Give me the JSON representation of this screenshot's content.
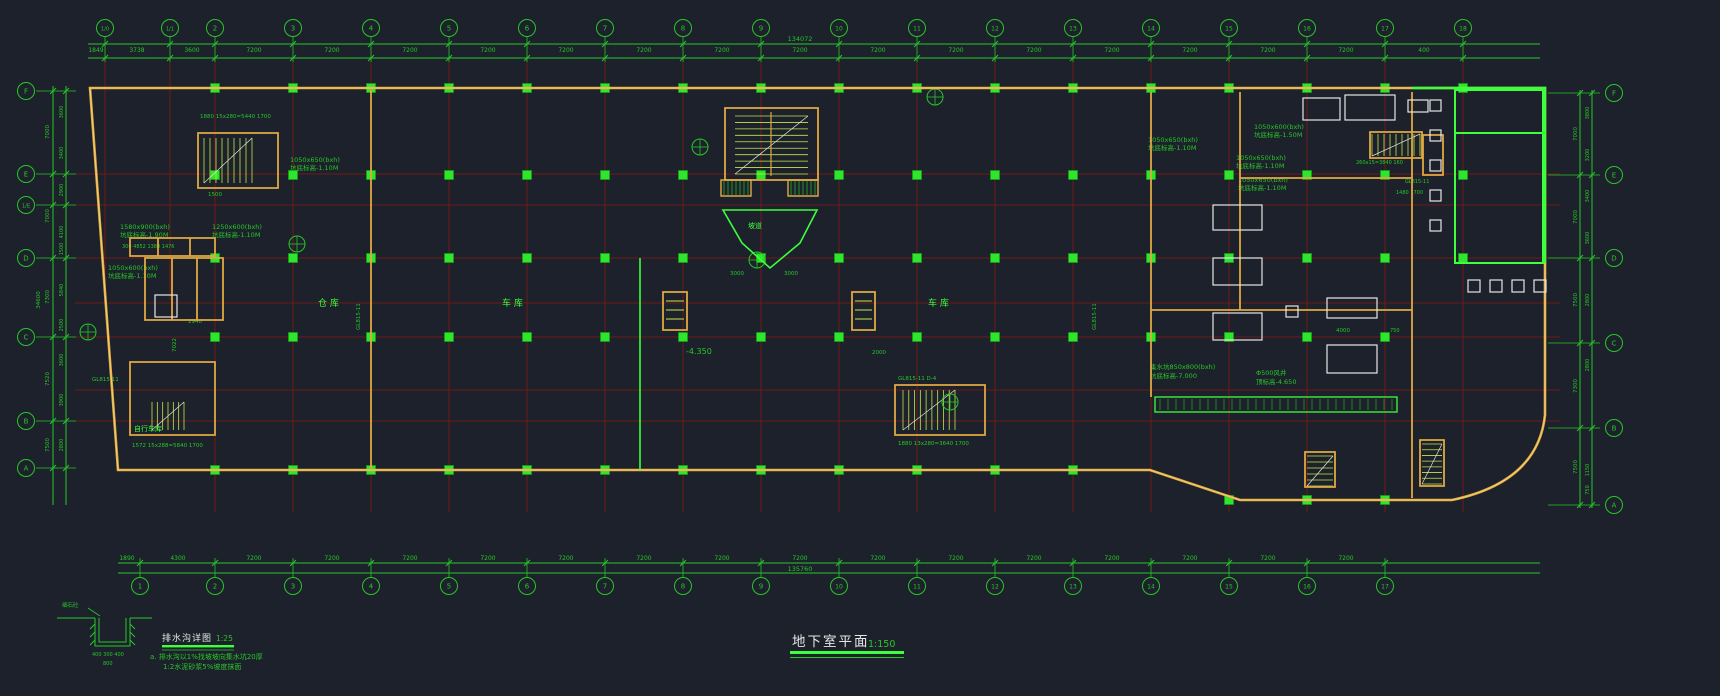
{
  "window": {
    "width": 1720,
    "height": 696
  },
  "colors": {
    "background": "#1c212b",
    "grid_red": "#6e1a1a",
    "dim_green": "#28c628",
    "bright_green": "#3dff3d",
    "column_green": "#2ee62e",
    "wall_yellow": "#e0a943",
    "wall_light": "#f6d879",
    "white": "#e6e6e6"
  },
  "title_block": {
    "title": "地下室平面",
    "scale": "1:150"
  },
  "detail_block": {
    "title": "排水沟详图",
    "scale": "1:25",
    "note1": "a. 排水沟以1%找坡坡向集水坑20厚",
    "note2": "1:2水泥砂浆5%坡度抹面",
    "dim1": "400  300  400",
    "dim2": "800",
    "label": "细石砼"
  },
  "grid": {
    "top_axes": [
      {
        "label": "1/0",
        "x": 105
      },
      {
        "label": "1/1",
        "x": 170
      },
      {
        "label": "2",
        "x": 215
      },
      {
        "label": "3",
        "x": 293
      },
      {
        "label": "4",
        "x": 371
      },
      {
        "label": "5",
        "x": 449
      },
      {
        "label": "6",
        "x": 527
      },
      {
        "label": "7",
        "x": 605
      },
      {
        "label": "8",
        "x": 683
      },
      {
        "label": "9",
        "x": 761
      },
      {
        "label": "10",
        "x": 839
      },
      {
        "label": "11",
        "x": 917
      },
      {
        "label": "12",
        "x": 995
      },
      {
        "label": "13",
        "x": 1073
      },
      {
        "label": "14",
        "x": 1151
      },
      {
        "label": "15",
        "x": 1229
      },
      {
        "label": "16",
        "x": 1307
      },
      {
        "label": "17",
        "x": 1385
      },
      {
        "label": "18",
        "x": 1463
      }
    ],
    "bottom_axes": [
      {
        "label": "1",
        "x": 140
      },
      {
        "label": "2",
        "x": 215
      },
      {
        "label": "3",
        "x": 293
      },
      {
        "label": "4",
        "x": 371
      },
      {
        "label": "5",
        "x": 449
      },
      {
        "label": "6",
        "x": 527
      },
      {
        "label": "7",
        "x": 605
      },
      {
        "label": "8",
        "x": 683
      },
      {
        "label": "9",
        "x": 761
      },
      {
        "label": "10",
        "x": 839
      },
      {
        "label": "11",
        "x": 917
      },
      {
        "label": "12",
        "x": 995
      },
      {
        "label": "13",
        "x": 1073
      },
      {
        "label": "14",
        "x": 1151
      },
      {
        "label": "15",
        "x": 1229
      },
      {
        "label": "16",
        "x": 1307
      },
      {
        "label": "17",
        "x": 1385
      }
    ],
    "left_axes": [
      {
        "label": "F",
        "y": 91
      },
      {
        "label": "E",
        "y": 174
      },
      {
        "label": "1/E",
        "y": 205
      },
      {
        "label": "D",
        "y": 258
      },
      {
        "label": "C",
        "y": 337
      },
      {
        "label": "B",
        "y": 421
      },
      {
        "label": "A",
        "y": 468
      }
    ],
    "right_axes": [
      {
        "label": "F",
        "y": 93
      },
      {
        "label": "E",
        "y": 175
      },
      {
        "label": "D",
        "y": 258
      },
      {
        "label": "C",
        "y": 343
      },
      {
        "label": "B",
        "y": 428
      },
      {
        "label": "A",
        "y": 505
      }
    ],
    "top_dims": [
      {
        "v": "1849",
        "x": 96
      },
      {
        "v": "3738",
        "x": 137
      },
      {
        "v": "3600",
        "x": 192
      },
      {
        "v": "7200",
        "x": 254
      },
      {
        "v": "7200",
        "x": 332
      },
      {
        "v": "7200",
        "x": 410
      },
      {
        "v": "7200",
        "x": 488
      },
      {
        "v": "7200",
        "x": 566
      },
      {
        "v": "7200",
        "x": 644
      },
      {
        "v": "7200",
        "x": 722
      },
      {
        "v": "7200",
        "x": 800
      },
      {
        "v": "7200",
        "x": 878
      },
      {
        "v": "7200",
        "x": 956
      },
      {
        "v": "7200",
        "x": 1034
      },
      {
        "v": "7200",
        "x": 1112
      },
      {
        "v": "7200",
        "x": 1190
      },
      {
        "v": "7200",
        "x": 1268
      },
      {
        "v": "7200",
        "x": 1346
      },
      {
        "v": "400",
        "x": 1424
      }
    ],
    "top_total": "134072",
    "bottom_dims": [
      {
        "v": "1890",
        "x": 127
      },
      {
        "v": "4300",
        "x": 178
      },
      {
        "v": "7200",
        "x": 254
      },
      {
        "v": "7200",
        "x": 332
      },
      {
        "v": "7200",
        "x": 410
      },
      {
        "v": "7200",
        "x": 488
      },
      {
        "v": "7200",
        "x": 566
      },
      {
        "v": "7200",
        "x": 644
      },
      {
        "v": "7200",
        "x": 722
      },
      {
        "v": "7200",
        "x": 800
      },
      {
        "v": "7200",
        "x": 878
      },
      {
        "v": "7200",
        "x": 956
      },
      {
        "v": "7200",
        "x": 1034
      },
      {
        "v": "7200",
        "x": 1112
      },
      {
        "v": "7200",
        "x": 1190
      },
      {
        "v": "7200",
        "x": 1268
      },
      {
        "v": "7200",
        "x": 1346
      }
    ],
    "bottom_total": "135760",
    "left_total": "34600",
    "left_dims_outer": [
      {
        "v": "7000",
        "y": 132
      },
      {
        "v": "7000",
        "y": 216
      },
      {
        "v": "7300",
        "y": 297
      },
      {
        "v": "7520",
        "y": 379
      },
      {
        "v": "7500",
        "y": 445
      }
    ],
    "left_dims_inner": [
      {
        "v": "3600",
        "y": 112
      },
      {
        "v": "3400",
        "y": 153
      },
      {
        "v": "2900",
        "y": 190
      },
      {
        "v": "4100",
        "y": 232
      },
      {
        "v": "1500",
        "y": 249
      },
      {
        "v": "5840",
        "y": 290
      },
      {
        "v": "2500",
        "y": 325
      },
      {
        "v": "3600",
        "y": 360
      },
      {
        "v": "3900",
        "y": 400
      },
      {
        "v": "2800",
        "y": 445
      }
    ],
    "right_dims_outer": [
      {
        "v": "7000",
        "y": 134
      },
      {
        "v": "7000",
        "y": 217
      },
      {
        "v": "7500",
        "y": 300
      },
      {
        "v": "7300",
        "y": 386
      },
      {
        "v": "7500",
        "y": 467
      }
    ],
    "right_dims_inner": [
      {
        "v": "3800",
        "y": 113
      },
      {
        "v": "3200",
        "y": 155
      },
      {
        "v": "3400",
        "y": 196
      },
      {
        "v": "3600",
        "y": 238
      },
      {
        "v": "2800",
        "y": 300
      },
      {
        "v": "2800",
        "y": 365
      },
      {
        "v": "1150",
        "y": 470
      },
      {
        "v": "750",
        "y": 490
      }
    ]
  },
  "rooms": [
    {
      "t": "仓  库",
      "x": 318,
      "y": 306,
      "s": 9
    },
    {
      "t": "车  库",
      "x": 502,
      "y": 306,
      "s": 9
    },
    {
      "t": "车  库",
      "x": 928,
      "y": 306,
      "s": 9
    },
    {
      "t": "坡道",
      "x": 748,
      "y": 228,
      "s": 7
    },
    {
      "t": "自行车库",
      "x": 134,
      "y": 431,
      "s": 7
    }
  ],
  "annotations": [
    {
      "t": "1580x900(bxh)",
      "x": 120,
      "y": 229
    },
    {
      "t": "坑底标高-1.90M",
      "x": 120,
      "y": 237
    },
    {
      "t": "1250x600(bxh)",
      "x": 212,
      "y": 229
    },
    {
      "t": "坑底标高-1.10M",
      "x": 212,
      "y": 237
    },
    {
      "t": "1050x600(bxh)",
      "x": 108,
      "y": 270
    },
    {
      "t": "坑底标高-1.10M",
      "x": 108,
      "y": 278
    },
    {
      "t": "1050x650(bxh)",
      "x": 290,
      "y": 162
    },
    {
      "t": "坑底标高-1.10M",
      "x": 290,
      "y": 170
    },
    {
      "t": "1050x650(bxh)",
      "x": 1148,
      "y": 142
    },
    {
      "t": "坑底标高-1.10M",
      "x": 1148,
      "y": 150
    },
    {
      "t": "1050x600(bxh)",
      "x": 1254,
      "y": 129
    },
    {
      "t": "坑底标高-1.50M",
      "x": 1254,
      "y": 137
    },
    {
      "t": "1050x650(bxh)",
      "x": 1236,
      "y": 160
    },
    {
      "t": "坑底标高-1.10M",
      "x": 1236,
      "y": 168
    },
    {
      "t": "1050x650(bxh)",
      "x": 1238,
      "y": 182
    },
    {
      "t": "坑底标高-1.10M",
      "x": 1238,
      "y": 190
    },
    {
      "t": "集水坑850x800(bxh)",
      "x": 1150,
      "y": 369
    },
    {
      "t": "坑底标高-7.000",
      "x": 1150,
      "y": 378
    },
    {
      "t": "Φ500风井",
      "x": 1256,
      "y": 375
    },
    {
      "t": "顶标高-4.650",
      "x": 1256,
      "y": 384
    },
    {
      "t": "-4.350",
      "x": 686,
      "y": 354,
      "s": 8
    },
    {
      "t": "GL815-11  D-4",
      "x": 898,
      "y": 380,
      "s": 5.5
    },
    {
      "t": "1880  15x280=5440  1700",
      "x": 200,
      "y": 118,
      "s": 5.5
    },
    {
      "t": "1880  13x280=3640  1700",
      "x": 898,
      "y": 445,
      "s": 5.5
    },
    {
      "t": "1572  15x288=5840  1700",
      "x": 132,
      "y": 447,
      "s": 5.5
    },
    {
      "t": "260x15=3840 160",
      "x": 1356,
      "y": 164,
      "s": 5
    },
    {
      "t": "1480  1700",
      "x": 1396,
      "y": 194,
      "s": 5
    },
    {
      "t": "1500",
      "x": 208,
      "y": 196,
      "s": 5.5
    },
    {
      "t": "2000",
      "x": 872,
      "y": 354,
      "s": 5.5
    },
    {
      "t": "4000",
      "x": 1336,
      "y": 332,
      "s": 5.5
    },
    {
      "t": "750",
      "x": 1390,
      "y": 332,
      "s": 5
    },
    {
      "t": "300  4852  1380 1476",
      "x": 122,
      "y": 248,
      "s": 5
    },
    {
      "t": "7022",
      "x": 176,
      "y": 352,
      "s": 5.5,
      "r": -90
    },
    {
      "t": "GL815-11",
      "x": 360,
      "y": 330,
      "s": 5.5,
      "r": -90
    },
    {
      "t": "GL815-11",
      "x": 1096,
      "y": 330,
      "s": 5.5,
      "r": -90
    },
    {
      "t": "GL815-11",
      "x": 1405,
      "y": 183,
      "s": 5
    },
    {
      "t": "GL815-11",
      "x": 92,
      "y": 381,
      "s": 5.5
    },
    {
      "t": "2940",
      "x": 188,
      "y": 323,
      "s": 5.5
    },
    {
      "t": "3000",
      "x": 730,
      "y": 275,
      "s": 5.5
    },
    {
      "t": "3000",
      "x": 784,
      "y": 275,
      "s": 5.5
    }
  ],
  "symbols": {
    "markers": [
      [
        88,
        332
      ],
      [
        297,
        244
      ],
      [
        935,
        97
      ],
      [
        950,
        402
      ],
      [
        700,
        147
      ],
      [
        757,
        260
      ]
    ]
  },
  "column_rows": [
    {
      "y": 88,
      "min": 95,
      "max": 1550
    },
    {
      "y": 175,
      "min": 98,
      "max": 1545
    },
    {
      "y": 258,
      "min": 102,
      "max": 1545
    },
    {
      "y": 337,
      "min": 108,
      "max": 1440
    },
    {
      "y": 470,
      "min": 118,
      "max": 1110
    },
    {
      "y": 500,
      "min": 1200,
      "max": 1420
    }
  ]
}
